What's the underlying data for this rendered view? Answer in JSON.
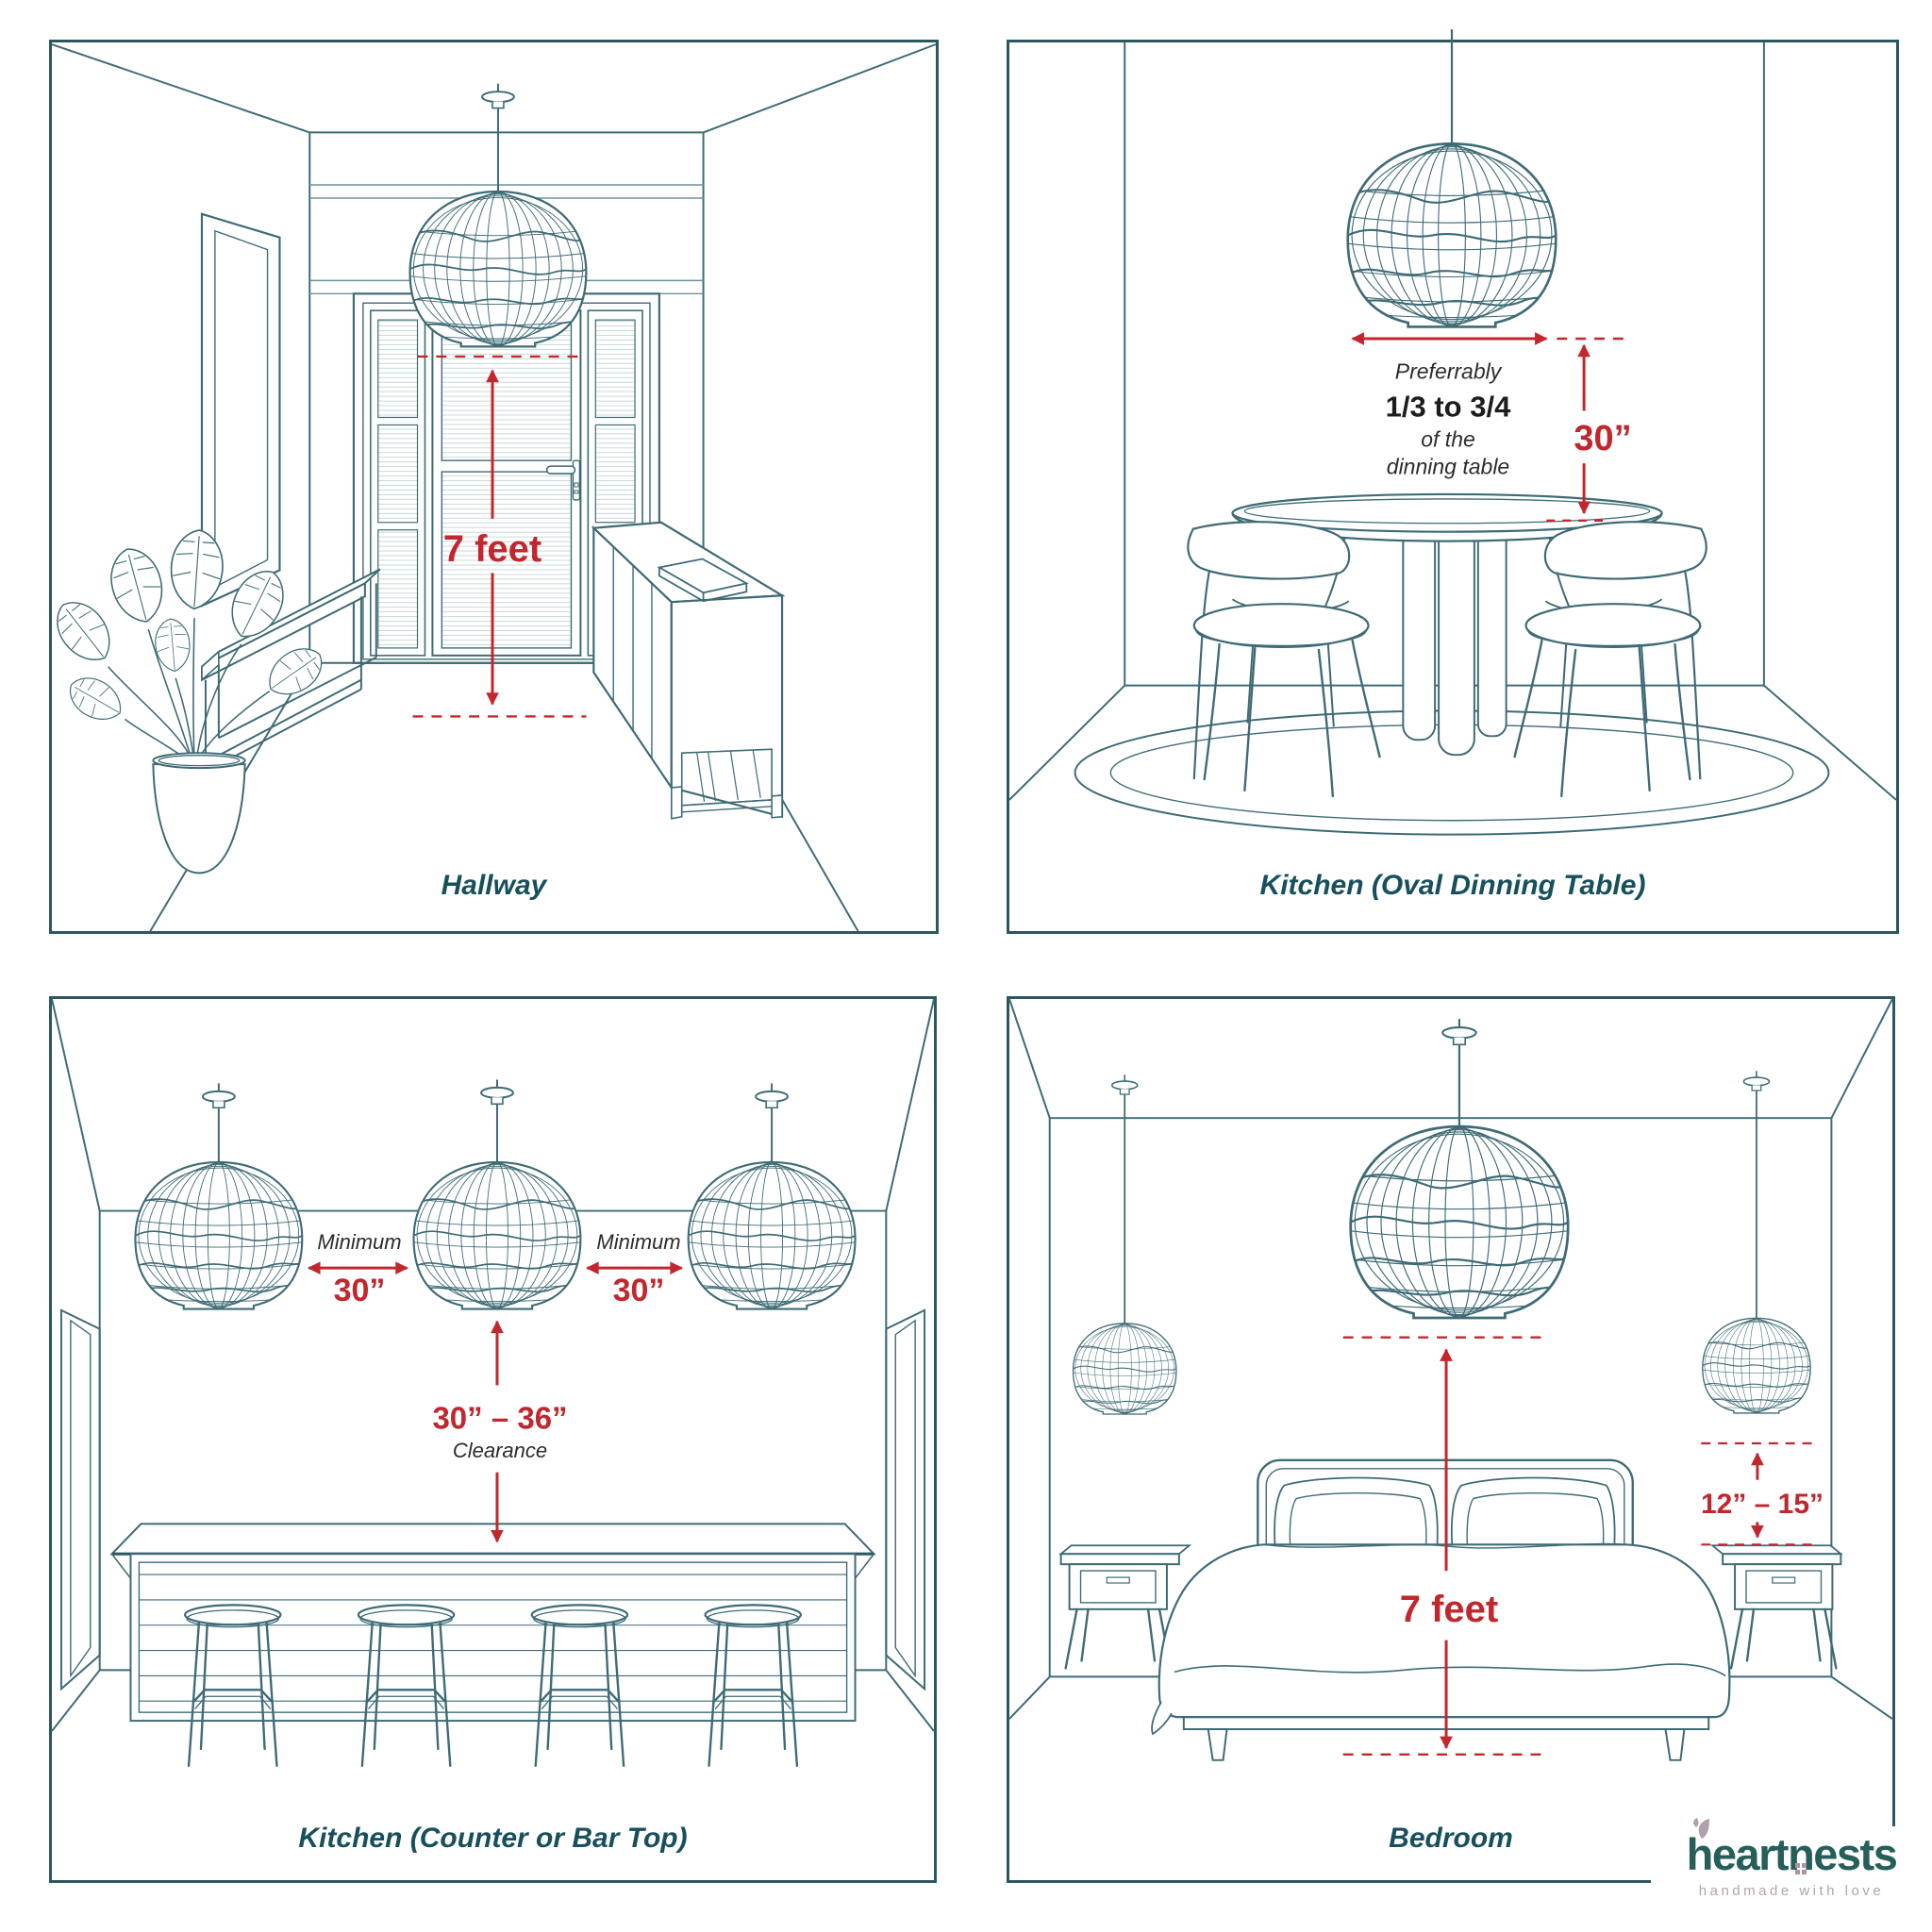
{
  "meta": {
    "background": "#ffffff",
    "ink_color": "#3e6b75",
    "border_color": "#2b5761",
    "caption_color": "#17505c",
    "accent_red": "#c1272d",
    "dark_text": "#2e2b2b",
    "logo_teal": "#265f5a",
    "logo_mauve": "#b4a2b0",
    "icons": [
      "pendant-lamp-icon",
      "leaf-icon",
      "house-window-icon"
    ]
  },
  "panels": {
    "hallway": {
      "caption": "Hallway",
      "height_measure": "7 feet"
    },
    "kitchen_oval": {
      "caption": "Kitchen (Oval Dinning Table)",
      "note": [
        "Preferrably",
        "1/3 to 3/4",
        "of the",
        "dinning table"
      ],
      "height_measure": "30”"
    },
    "kitchen_counter": {
      "caption": "Kitchen (Counter or Bar Top)",
      "spacing": [
        {
          "label": "Minimum",
          "value": "30”"
        },
        {
          "label": "Minimum",
          "value": "30”"
        }
      ],
      "clearance": {
        "value": "30” – 36”",
        "label": "Clearance"
      }
    },
    "bedroom": {
      "caption": "Bedroom",
      "center_measure": "7 feet",
      "side_measure": "12” – 15”"
    }
  },
  "logo": {
    "part1": "heart",
    "part2": "n",
    "part3": "ests",
    "tagline": "handmade with love"
  }
}
